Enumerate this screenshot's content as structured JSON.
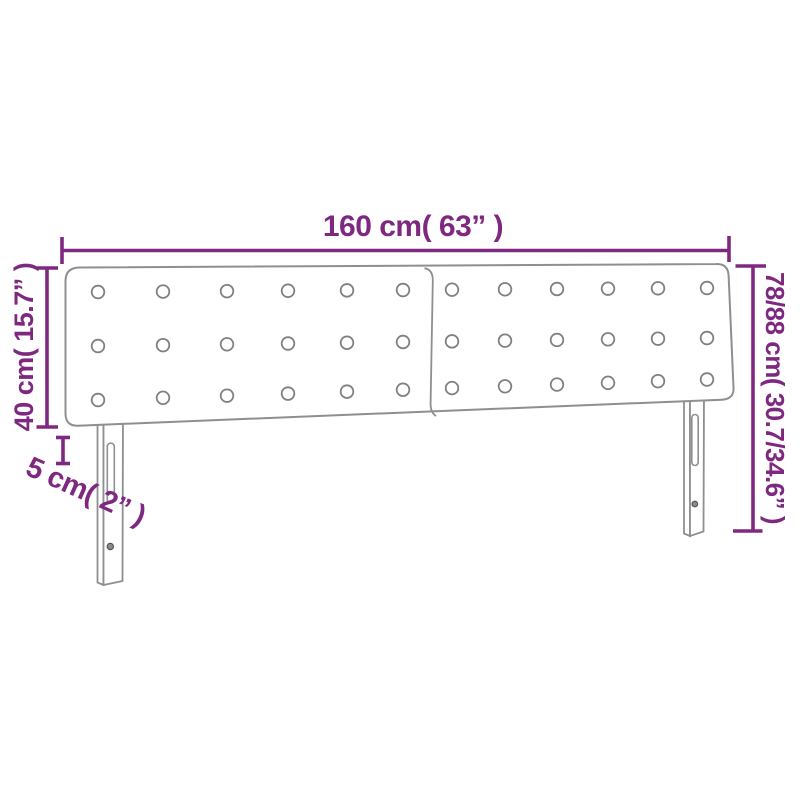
{
  "diagram": {
    "product": "upholstered-headboard-with-legs",
    "dimension_labels": {
      "width": "160 cm( 63” )",
      "panel_height": "40 cm( 15.7” )",
      "depth": "5 cm( 2” )",
      "total_height": "78/88 cm( 30.7/34.6” )"
    },
    "colors": {
      "dimension": "#7E2880",
      "outline": "#8F8F8F",
      "background": "#FFFFFF"
    },
    "tufting": {
      "rows": 3,
      "columns": 12
    },
    "legs": 2
  }
}
